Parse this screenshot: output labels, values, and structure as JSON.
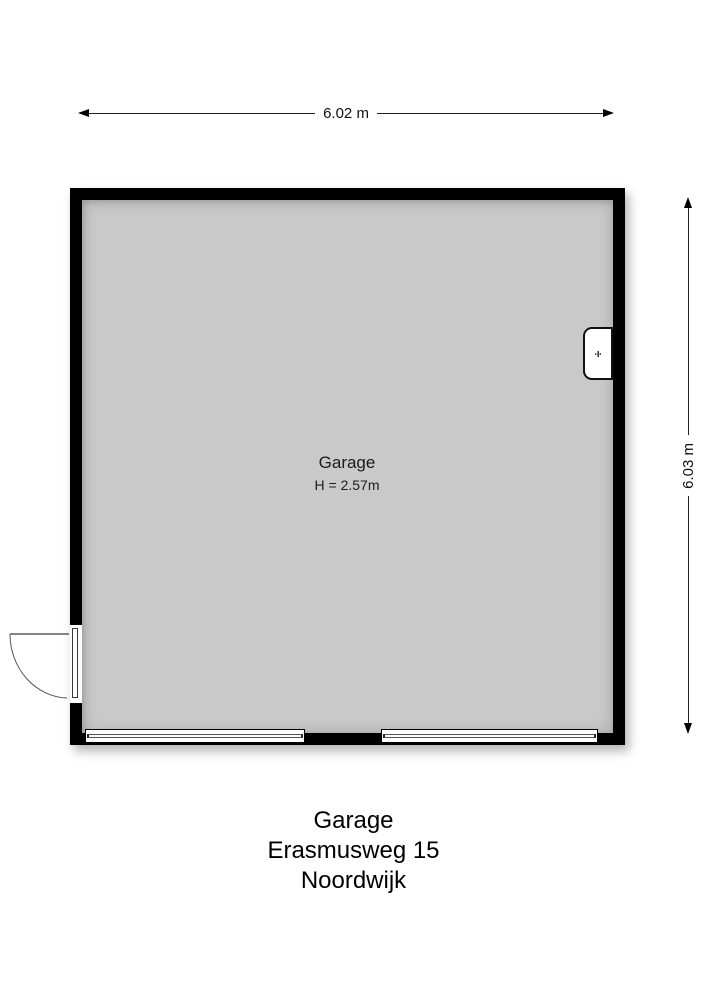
{
  "plan": {
    "room": {
      "label": "Garage",
      "height_text": "H = 2.57m"
    },
    "dimensions": {
      "width": "6.02 m",
      "height": "6.03 m"
    },
    "fixture_symbol": "÷"
  },
  "footer": {
    "line1": "Garage",
    "line2": "Erasmusweg 15",
    "line3": "Noordwijk"
  },
  "colors": {
    "floor": "#c9c9c9",
    "wall": "#000000",
    "dimension_line": "#222222"
  }
}
